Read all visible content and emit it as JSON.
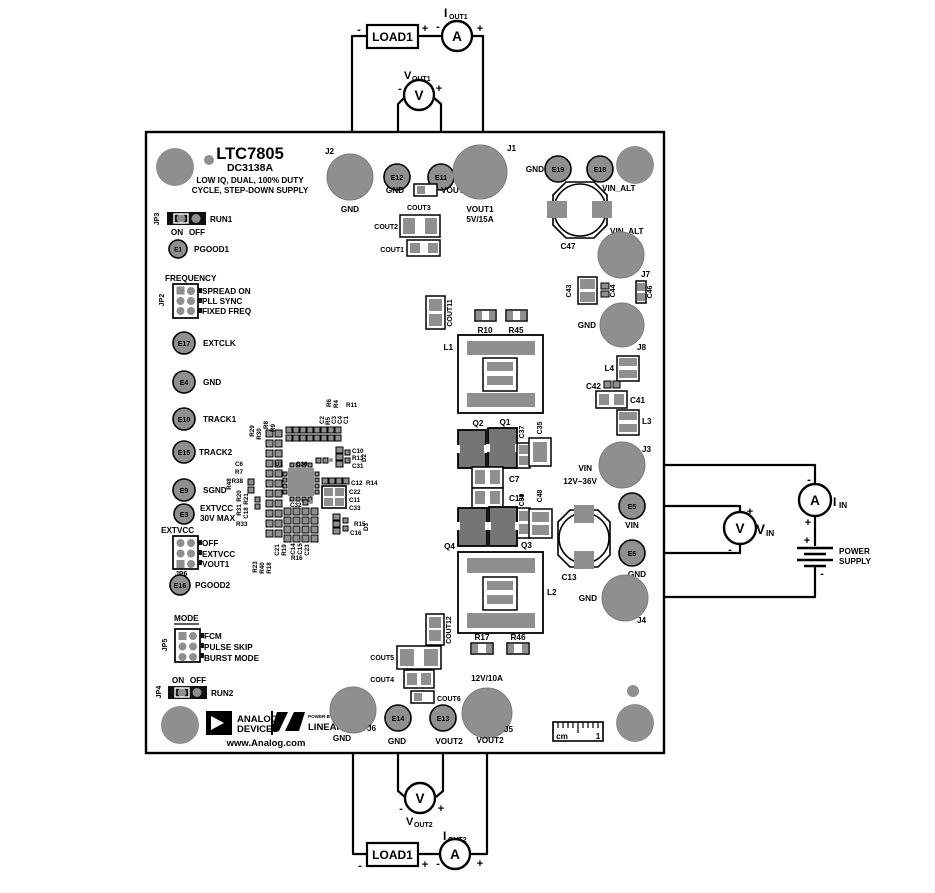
{
  "meta": {
    "plus": "+",
    "minus": "-",
    "ammeter_symbol": "A",
    "voltmeter_symbol": "V"
  },
  "board": {
    "part_number": "LTC7805",
    "demo_number": "DC3138A",
    "desc_line1": "LOW IQ, DUAL, 100% DUTY",
    "desc_line2": "CYCLE, STEP-DOWN SUPPLY",
    "website": "www.Analog.com",
    "logo": {
      "brand_line1": "ANALOG",
      "brand_line2": "DEVICES",
      "power_by": "POWER BY",
      "linear": "LINEAR"
    },
    "ruler": {
      "unit": "cm",
      "mark_1": "1"
    }
  },
  "jumpers": {
    "jp3": {
      "id": "JP3",
      "label": "RUN1",
      "opt_on": "ON",
      "opt_off": "OFF"
    },
    "jp2": {
      "id": "JP2",
      "header": "FREQUENCY",
      "opt1": "SPREAD ON",
      "opt2": "PLL SYNC",
      "opt3": "FIXED FREQ"
    },
    "jp6": {
      "id": "JP6",
      "header": "EXTVCC",
      "opt1": "OFF",
      "opt2": "EXTVCC",
      "opt3": "VOUT1"
    },
    "jp5": {
      "id": "JP5",
      "header": "MODE",
      "opt1": "FCM",
      "opt2": "PULSE SKIP",
      "opt3": "BURST MODE"
    },
    "jp4": {
      "id": "JP4",
      "label": "RUN2",
      "opt_on": "ON",
      "opt_off": "OFF"
    }
  },
  "turrets": {
    "e1": {
      "id": "E1",
      "label": "PGOOD1"
    },
    "e17": {
      "id": "E17",
      "label": "EXTCLK"
    },
    "e4": {
      "id": "E4",
      "label": "GND"
    },
    "e10": {
      "id": "E10",
      "label": "TRACK1"
    },
    "e15": {
      "id": "E15",
      "label": "TRACK2"
    },
    "e9": {
      "id": "E9",
      "label": "SGND"
    },
    "e3": {
      "id": "E3",
      "label": "EXTVCC",
      "label2": "30V MAX"
    },
    "e16": {
      "id": "E16",
      "label": "PGOOD2"
    },
    "e12": {
      "id": "E12",
      "label": "GND"
    },
    "e11": {
      "id": "E11",
      "label": "VOUT1"
    },
    "e19": {
      "id": "E19",
      "label": "GND"
    },
    "e18": {
      "id": "E18",
      "label": "VIN_ALT"
    },
    "e5": {
      "id": "E5",
      "label": "VIN"
    },
    "e6": {
      "id": "E6",
      "label": "GND"
    },
    "e14": {
      "id": "E14",
      "label": "GND"
    },
    "e13": {
      "id": "E13",
      "label": "VOUT2"
    }
  },
  "jacks": {
    "j2": {
      "id": "J2",
      "label": "GND"
    },
    "j1": {
      "id": "J1",
      "label": "VOUT1",
      "rating": "5V/15A"
    },
    "j7": {
      "id": "J7",
      "label": "VIN_ALT"
    },
    "j8": {
      "id": "J8",
      "label": "GND"
    },
    "j3": {
      "id": "J3",
      "label": "VIN",
      "rating": "12V–36V"
    },
    "j4": {
      "id": "J4",
      "label": "GND"
    },
    "j6": {
      "id": "J6",
      "label": "GND"
    },
    "j5": {
      "id": "J5",
      "label": "VOUT2",
      "rating": "12V/10A"
    }
  },
  "refdes": {
    "cout1": "COUT1",
    "cout2": "COUT2",
    "cout3": "COUT3",
    "cout4": "COUT4",
    "cout5": "COUT5",
    "cout6": "COUT6",
    "cout11": "COUT11",
    "cout12": "COUT12",
    "c47": "C47",
    "c43": "C43",
    "c44": "C44",
    "c46": "C46",
    "c42": "C42",
    "c41": "C41",
    "c13": "C13",
    "l1": "L1",
    "l2": "L2",
    "l3": "L3",
    "l4": "L4",
    "r10": "R10",
    "r45": "R45",
    "r17": "R17",
    "r46": "R46",
    "q1": "Q1",
    "q2": "Q2",
    "q3": "Q3",
    "q4": "Q4",
    "c35": "C35",
    "c37": "C37",
    "c39": "C39",
    "c48": "C48",
    "c7": "C7",
    "c17": "C17",
    "u1": "U1",
    "c30": "C30",
    "c32": "C32",
    "r29": "R29",
    "r30": "R30",
    "r8": "R8",
    "r9": "R9",
    "r6": "R6",
    "r4": "R4",
    "r11": "R11",
    "c2": "C2",
    "r5": "R5",
    "c3": "C3",
    "c4": "C4",
    "c1": "C1",
    "c10": "C10",
    "r13": "R13",
    "c31": "C31",
    "d2": "D2",
    "c12": "C12",
    "r14": "R14",
    "c22": "C22",
    "c11": "C11",
    "c33": "C33",
    "r15": "R15",
    "d3": "D3",
    "c16": "C16",
    "c6": "C6",
    "r7": "R7",
    "r38": "R38",
    "r48": "R48",
    "r20": "R20",
    "r31": "R31",
    "r21": "R21",
    "c18": "C18",
    "r33": "R33",
    "c21": "C21",
    "r19": "R19",
    "c14": "C14",
    "c15": "C15",
    "c23": "C23",
    "r16": "R16",
    "r23": "R23",
    "r40": "R40",
    "r18": "R18"
  },
  "external": {
    "load1": "LOAD1",
    "load2": "LOAD1",
    "iout1": {
      "sym": "I",
      "sub": "OUT1"
    },
    "vout1": {
      "sym": "V",
      "sub": "OUT1"
    },
    "iout2": {
      "sym": "I",
      "sub": "OUT2"
    },
    "vout2": {
      "sym": "V",
      "sub": "OUT2"
    },
    "iin": {
      "sym": "I",
      "sub": "IN"
    },
    "vin": {
      "sym": "V",
      "sub": "IN"
    },
    "power_supply_line1": "POWER",
    "power_supply_line2": "SUPPLY"
  }
}
